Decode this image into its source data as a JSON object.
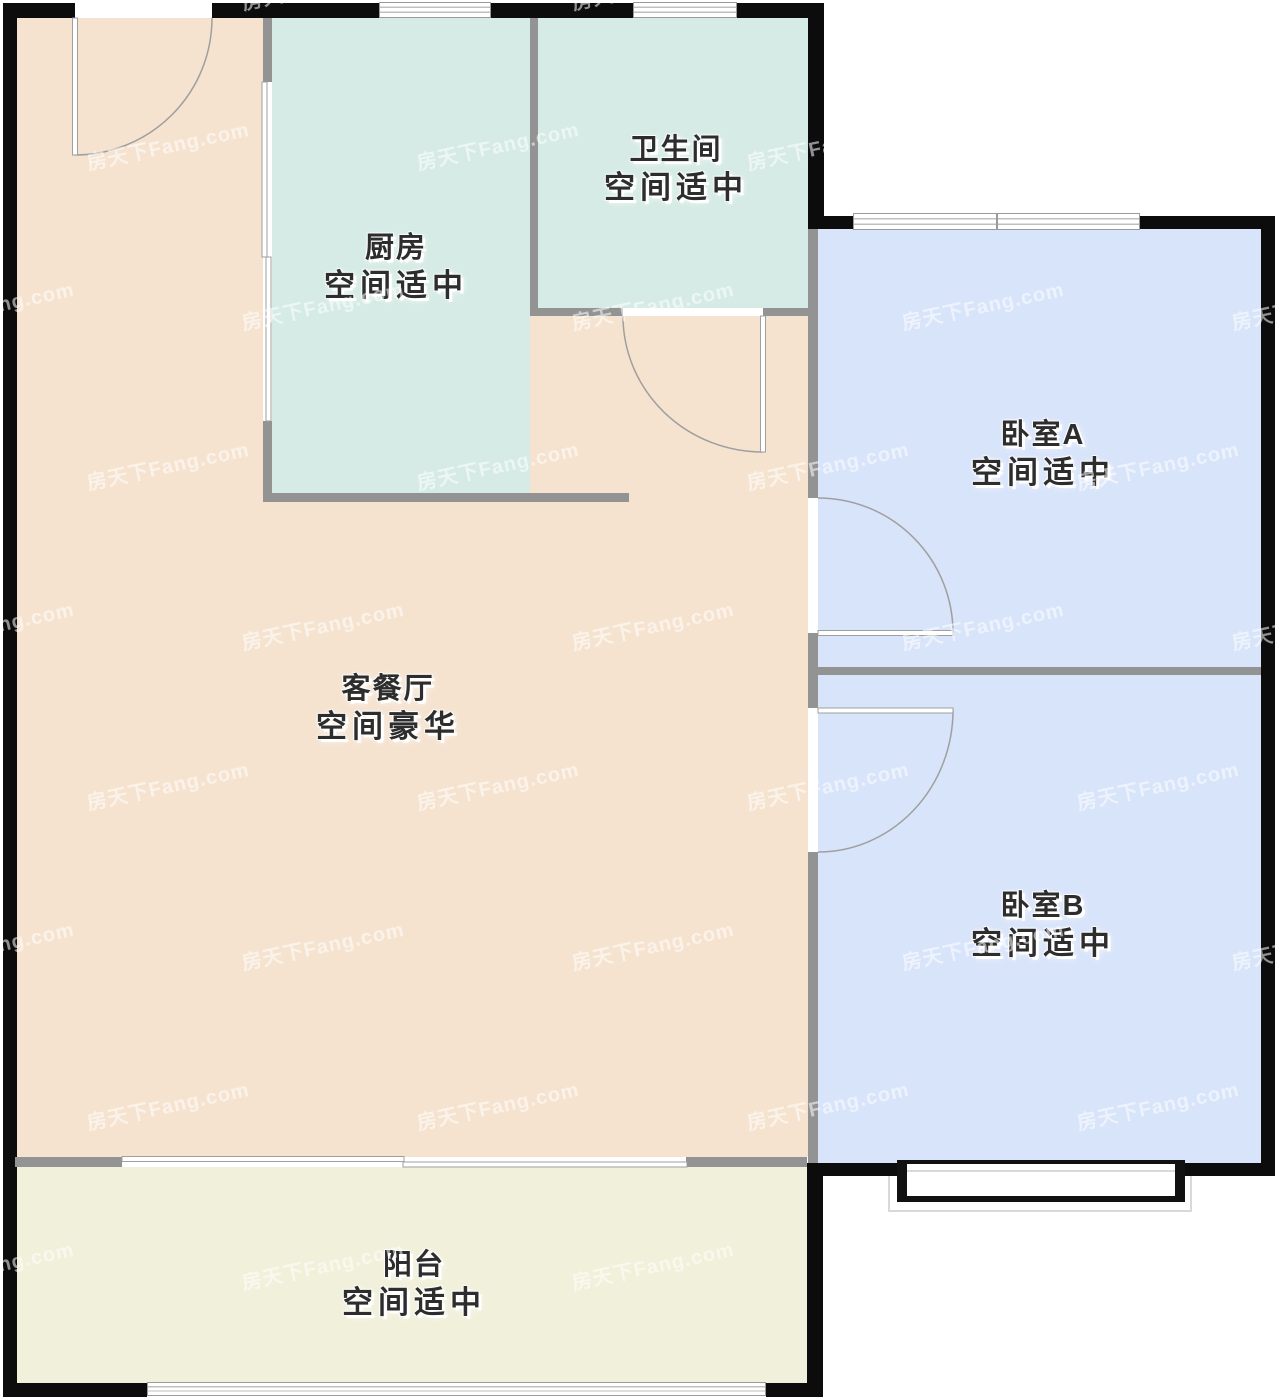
{
  "plan": {
    "watermark_text": "房天下Fang.com",
    "rooms": [
      {
        "key": "kitchen",
        "name": "厨房",
        "status": "空间适中"
      },
      {
        "key": "bathroom",
        "name": "卫生间",
        "status": "空间适中"
      },
      {
        "key": "living-dining",
        "name": "客餐厅",
        "status": "空间豪华"
      },
      {
        "key": "bedroom-a",
        "name": "卧室A",
        "status": "空间适中"
      },
      {
        "key": "bedroom-b",
        "name": "卧室B",
        "status": "空间适中"
      },
      {
        "key": "balcony",
        "name": "阳台",
        "status": "空间适中"
      }
    ],
    "colors": {
      "kitchen_bath": "#d6ebe5",
      "living": "#f5e3d0",
      "bedroom": "#d8e4fa",
      "balcony": "#f1f0da",
      "interior_wall": "#939393",
      "exterior_wall": "#0c0c0c"
    }
  }
}
